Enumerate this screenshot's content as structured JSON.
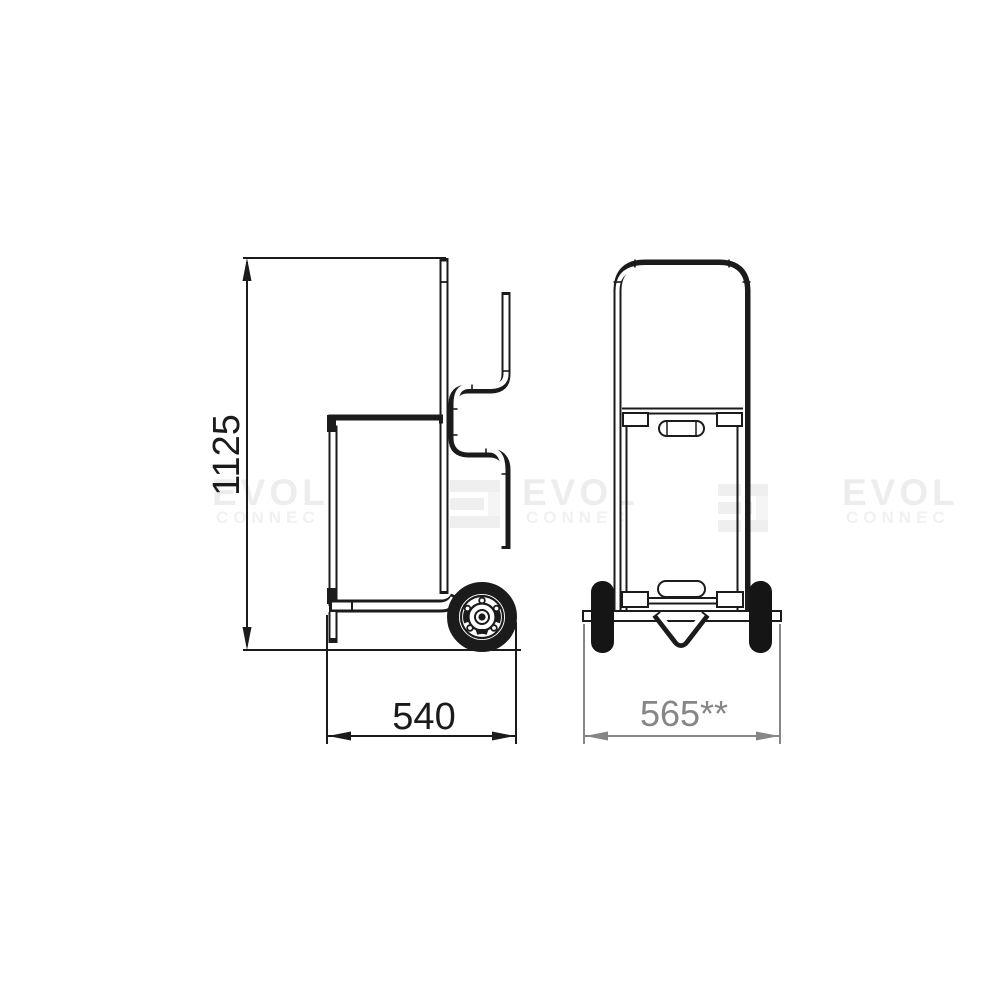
{
  "drawing": {
    "dimensions": {
      "height_label": "1125",
      "depth_label": "540",
      "width_label": "565**"
    },
    "colors": {
      "line": "#1b1b1b",
      "secondary_dimension": "#868686",
      "watermark": "#ededed",
      "background": "#ffffff"
    },
    "watermark": {
      "text_large": "EVOL",
      "text_small": "CONNEC"
    }
  }
}
